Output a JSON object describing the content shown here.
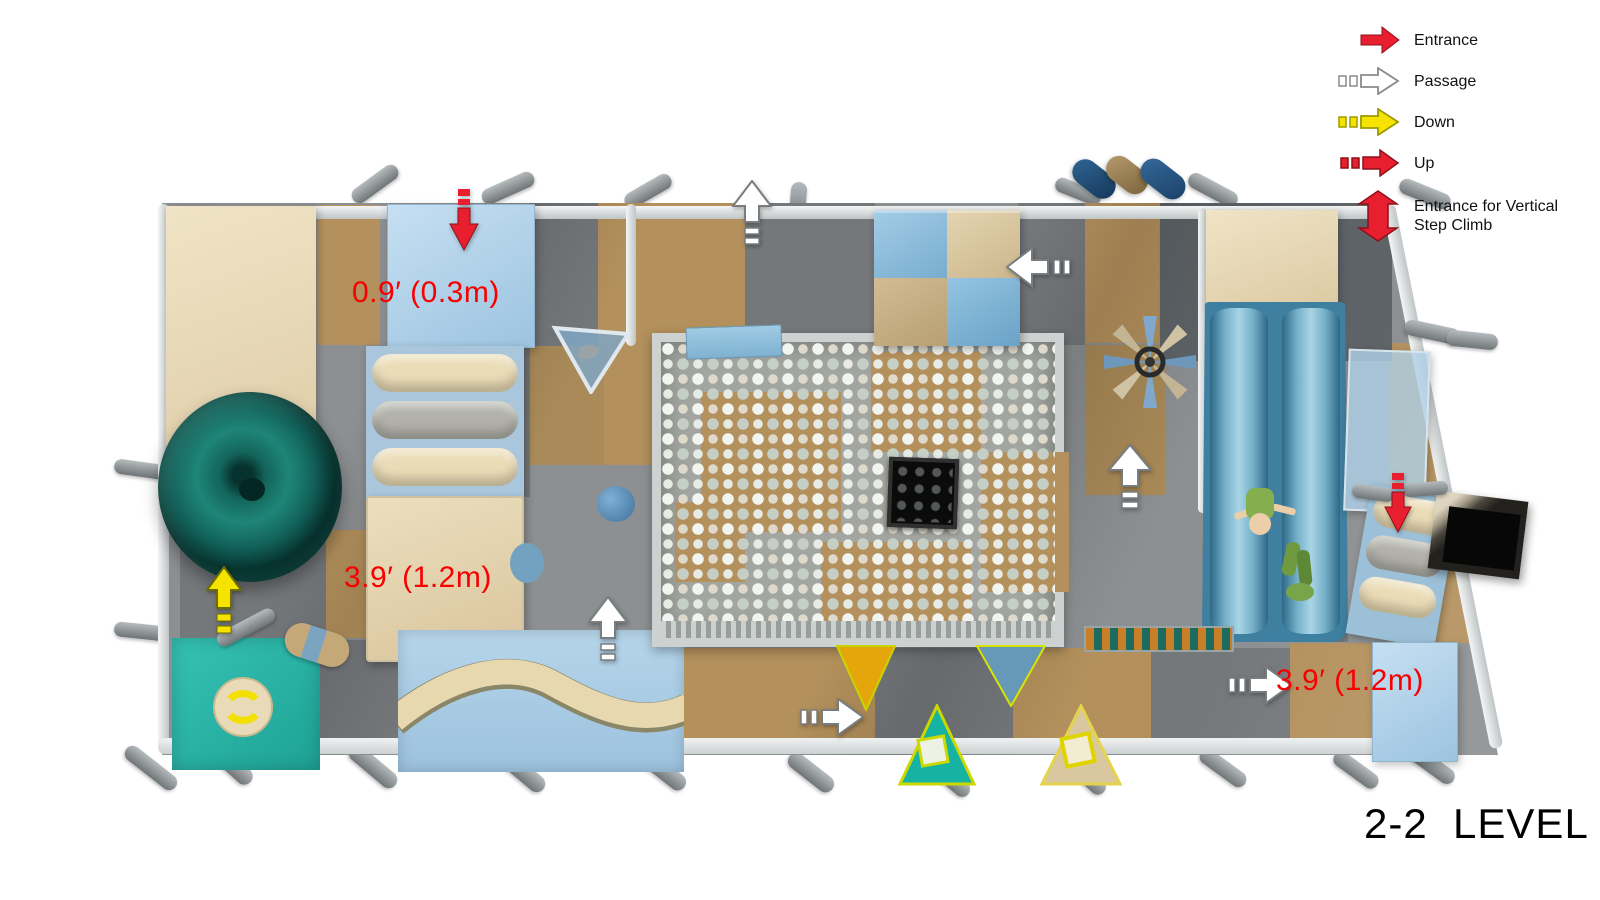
{
  "title": "2-2  LEVEL",
  "legend": {
    "items": [
      {
        "id": "entrance",
        "label": "Entrance",
        "icon": "red-right-arrow",
        "color": "#e81f2e"
      },
      {
        "id": "passage",
        "label": "Passage",
        "icon": "white-outline-arrow-with-dashes",
        "color": "#ffffff"
      },
      {
        "id": "down",
        "label": "Down",
        "icon": "yellow-arrow-with-dashes",
        "color": "#f6e400"
      },
      {
        "id": "up",
        "label": "Up",
        "icon": "red-arrow-with-dashes",
        "color": "#e81f2e"
      },
      {
        "id": "entrance-vertical-step-climb",
        "label": "Entrance for Vertical Step Climb",
        "icon": "red-double-vertical-arrow",
        "color": "#e81f2e"
      }
    ]
  },
  "measurements": {
    "down_platform": "0.9′ (0.3m)",
    "left_platform": "3.9′ (1.2m)",
    "right_platform": "3.9′ (1.2m)"
  },
  "colors": {
    "arrow_red": "#e81f2e",
    "arrow_yellow": "#f6e400",
    "label_red": "#f70000",
    "floor_tan": "#b3905c",
    "floor_gray": "#8d9092",
    "floor_dark": "#5e6367",
    "panel_blue": "#aacfe6",
    "slide_blue": "#4e8fae",
    "bowl_teal": "#13655b",
    "mat_teal": "#2cb3a6",
    "panel_cream": "#ecdfc2"
  }
}
